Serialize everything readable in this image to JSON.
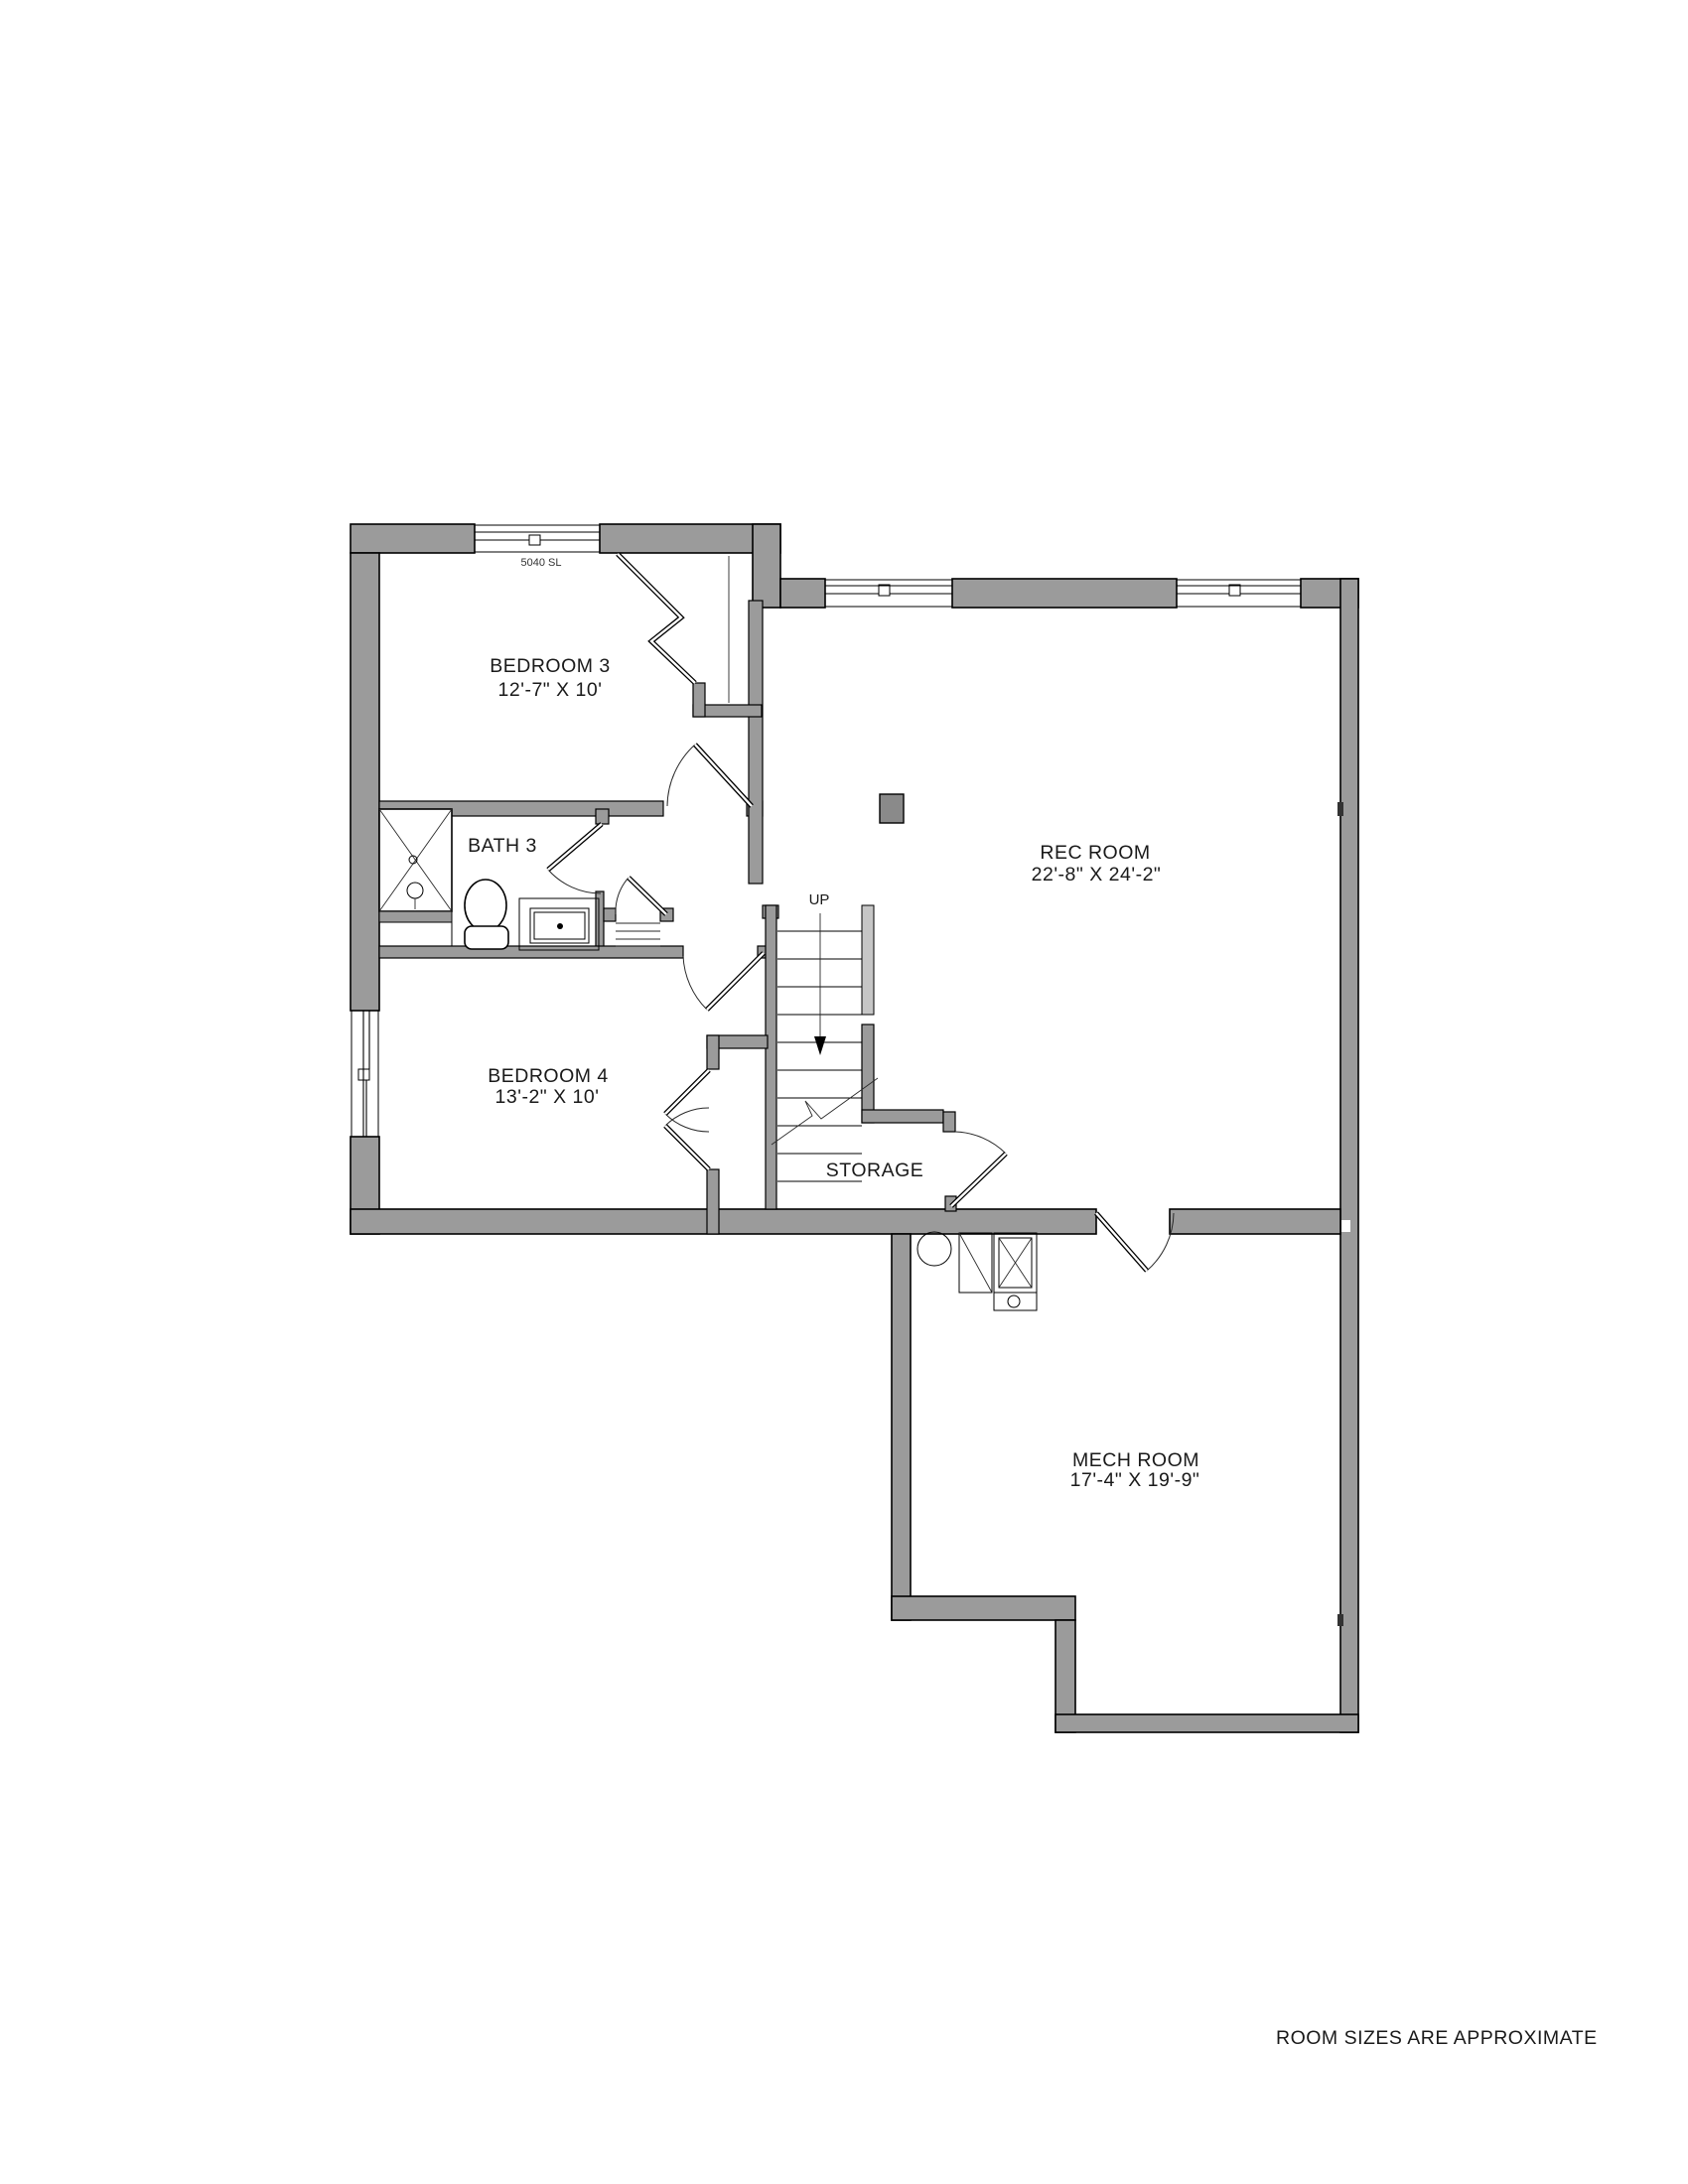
{
  "document": {
    "type": "basement floor plan",
    "background": "#ffffff",
    "footnote": "ROOM SIZES ARE APPROXIMATE"
  },
  "colors": {
    "wall": "#9b9b9b",
    "wall_light": "#c6c6c6",
    "outline": "#000000",
    "text": "#1a1a1a",
    "column": "#8a8a8a"
  },
  "rooms": [
    {
      "id": "bedroom-3",
      "name": "BEDROOM 3",
      "dims": "12'-7\" X 10'"
    },
    {
      "id": "bath-3",
      "name": "BATH 3"
    },
    {
      "id": "rec-room",
      "name": "REC ROOM",
      "dims": "22'-8\" X 24'-2\""
    },
    {
      "id": "bedroom-4",
      "name": "BEDROOM 4",
      "dims": "13'-2\" X 10'"
    },
    {
      "id": "storage",
      "name": "STORAGE"
    },
    {
      "id": "mech-room",
      "name": "MECH ROOM",
      "dims": "17'-4\" X 19'-9\""
    }
  ],
  "annotations": {
    "stair_direction": "UP",
    "window_label": "5040 SL"
  }
}
